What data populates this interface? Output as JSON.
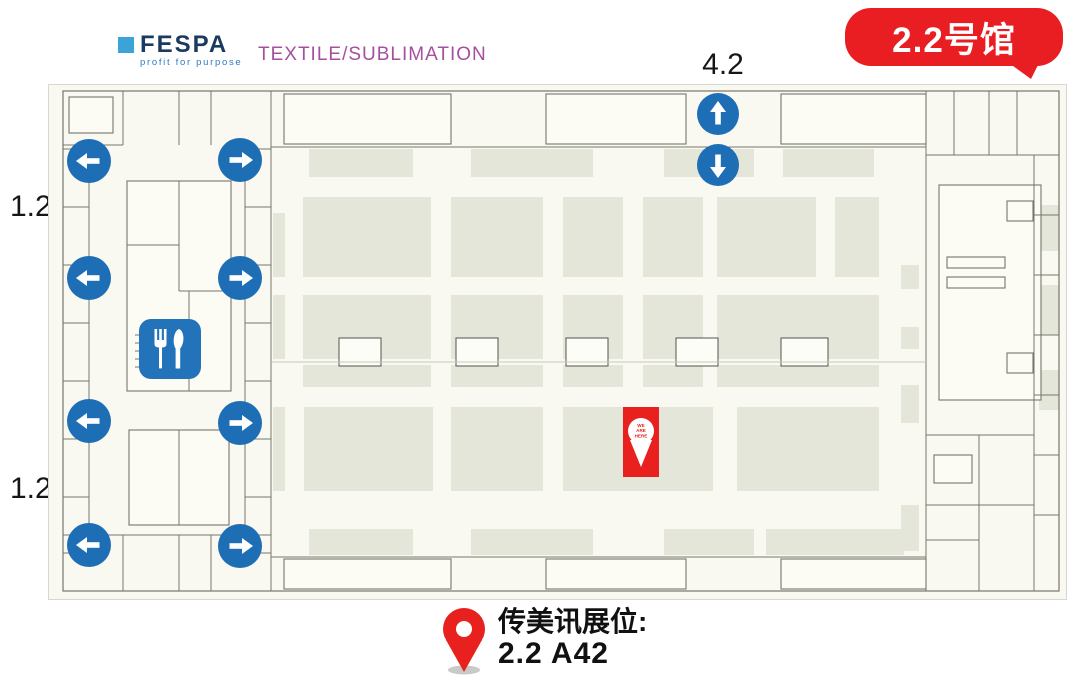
{
  "header": {
    "logo": {
      "name": "FESPA",
      "tagline": "profit for purpose"
    },
    "event_label": "TEXTILE/SUBLIMATION",
    "hall_badge": "2.2号馆"
  },
  "labels": {
    "top_hall": "4.2",
    "left_upper": "1.2",
    "left_lower": "1.2"
  },
  "legend": {
    "title": "传美讯展位:",
    "booth": "2.2 A42"
  },
  "colors": {
    "badge_red": "#e91e22",
    "marker_red": "#e8211f",
    "arrow_blue": "#1d6eb5",
    "restaurant_blue": "#2273b9",
    "fespa_navy": "#1a3a5f",
    "fespa_square_blue": "#3aa3d8",
    "fespa_tagline_blue": "#2e7cc0",
    "textile_purple": "#a4509e",
    "booth_sage": "#e4e6d9",
    "plan_background": "#faf9f1",
    "wall_gray": "#77766c"
  },
  "floorplan": {
    "width": 1017,
    "height": 514,
    "booth_color": "#e4e6d9",
    "room_fill": "#fcfbf4",
    "wall_color": "#77766c",
    "light_wall": "#c8c7ba",
    "boundary": [
      14,
      6,
      996,
      500
    ],
    "booths": [
      [
        260,
        64,
        104,
        28
      ],
      [
        422,
        64,
        122,
        28
      ],
      [
        615,
        64,
        90,
        28
      ],
      [
        734,
        64,
        91,
        28
      ],
      [
        254,
        112,
        128,
        80
      ],
      [
        402,
        112,
        92,
        80
      ],
      [
        514,
        112,
        60,
        80
      ],
      [
        594,
        112,
        60,
        80
      ],
      [
        668,
        112,
        99,
        80
      ],
      [
        786,
        112,
        44,
        80
      ],
      [
        254,
        210,
        128,
        64
      ],
      [
        402,
        210,
        92,
        64
      ],
      [
        514,
        210,
        60,
        64
      ],
      [
        594,
        210,
        60,
        64
      ],
      [
        668,
        210,
        162,
        64
      ],
      [
        254,
        280,
        128,
        22
      ],
      [
        402,
        280,
        92,
        22
      ],
      [
        514,
        280,
        60,
        22
      ],
      [
        594,
        280,
        60,
        22
      ],
      [
        668,
        280,
        162,
        22
      ],
      [
        255,
        322,
        129,
        84
      ],
      [
        402,
        322,
        92,
        84
      ],
      [
        514,
        322,
        150,
        84
      ],
      [
        688,
        322,
        142,
        84
      ],
      [
        260,
        444,
        104,
        26
      ],
      [
        422,
        444,
        122,
        26
      ],
      [
        615,
        444,
        90,
        26
      ],
      [
        717,
        444,
        138,
        26
      ],
      [
        224,
        128,
        12,
        64
      ],
      [
        224,
        210,
        12,
        64
      ],
      [
        224,
        322,
        12,
        84
      ],
      [
        852,
        180,
        18,
        24
      ],
      [
        852,
        242,
        18,
        22
      ],
      [
        852,
        300,
        18,
        38
      ],
      [
        852,
        420,
        18,
        46
      ],
      [
        990,
        120,
        20,
        46
      ],
      [
        990,
        200,
        20,
        50
      ],
      [
        990,
        285,
        20,
        40
      ]
    ],
    "rooms_outlined": [
      [
        235,
        9,
        167,
        50
      ],
      [
        497,
        9,
        140,
        50
      ],
      [
        732,
        9,
        145,
        50
      ],
      [
        235,
        474,
        167,
        30
      ],
      [
        497,
        474,
        140,
        30
      ],
      [
        732,
        474,
        145,
        30
      ],
      [
        78,
        96,
        104,
        210
      ],
      [
        80,
        345,
        100,
        95
      ],
      [
        20,
        12,
        44,
        36
      ],
      [
        890,
        100,
        102,
        215
      ],
      [
        898,
        172,
        58,
        11
      ],
      [
        898,
        192,
        58,
        11
      ],
      [
        958,
        116,
        26,
        20
      ],
      [
        958,
        268,
        26,
        20
      ],
      [
        885,
        370,
        38,
        28
      ]
    ],
    "inset_rooms": [
      [
        290,
        253,
        42,
        28
      ],
      [
        407,
        253,
        42,
        28
      ],
      [
        517,
        253,
        42,
        28
      ],
      [
        627,
        253,
        42,
        28
      ],
      [
        732,
        253,
        47,
        28
      ]
    ],
    "walls": [
      [
        222,
        6,
        222,
        506
      ],
      [
        877,
        6,
        877,
        506
      ],
      [
        40,
        64,
        40,
        468
      ],
      [
        14,
        64,
        40,
        64
      ],
      [
        14,
        122,
        40,
        122
      ],
      [
        14,
        180,
        40,
        180
      ],
      [
        14,
        238,
        40,
        238
      ],
      [
        14,
        296,
        40,
        296
      ],
      [
        14,
        354,
        40,
        354
      ],
      [
        14,
        412,
        40,
        412
      ],
      [
        14,
        468,
        40,
        468
      ],
      [
        196,
        64,
        196,
        468
      ],
      [
        196,
        64,
        222,
        64
      ],
      [
        196,
        122,
        222,
        122
      ],
      [
        196,
        180,
        222,
        180
      ],
      [
        196,
        238,
        222,
        238
      ],
      [
        196,
        296,
        222,
        296
      ],
      [
        196,
        354,
        222,
        354
      ],
      [
        196,
        412,
        222,
        412
      ],
      [
        196,
        468,
        222,
        468
      ],
      [
        74,
        6,
        74,
        60
      ],
      [
        130,
        6,
        130,
        60
      ],
      [
        162,
        6,
        162,
        60
      ],
      [
        14,
        60,
        74,
        60
      ],
      [
        14,
        450,
        222,
        450
      ],
      [
        74,
        450,
        74,
        506
      ],
      [
        130,
        450,
        130,
        506
      ],
      [
        162,
        450,
        162,
        506
      ],
      [
        130,
        96,
        130,
        206
      ],
      [
        78,
        160,
        130,
        160
      ],
      [
        130,
        206,
        182,
        206
      ],
      [
        140,
        206,
        140,
        306
      ],
      [
        86,
        250,
        116,
        250
      ],
      [
        86,
        258,
        116,
        258
      ],
      [
        86,
        266,
        116,
        266
      ],
      [
        86,
        274,
        116,
        274
      ],
      [
        86,
        282,
        116,
        282
      ],
      [
        116,
        246,
        116,
        286
      ],
      [
        130,
        345,
        130,
        440
      ],
      [
        877,
        70,
        1010,
        70
      ],
      [
        905,
        6,
        905,
        70
      ],
      [
        940,
        6,
        940,
        70
      ],
      [
        968,
        6,
        968,
        70
      ],
      [
        985,
        70,
        985,
        506
      ],
      [
        985,
        130,
        1010,
        130
      ],
      [
        985,
        190,
        1010,
        190
      ],
      [
        985,
        250,
        1010,
        250
      ],
      [
        985,
        310,
        1010,
        310
      ],
      [
        985,
        370,
        1010,
        370
      ],
      [
        985,
        430,
        1010,
        430
      ],
      [
        877,
        350,
        985,
        350
      ],
      [
        877,
        420,
        985,
        420
      ],
      [
        930,
        350,
        930,
        506
      ],
      [
        877,
        455,
        930,
        455
      ],
      [
        222,
        472,
        877,
        472
      ],
      [
        222,
        62,
        877,
        62
      ]
    ],
    "light_lines": [
      [
        222,
        277,
        877,
        277
      ]
    ],
    "arrows": {
      "color": "#1d6eb5",
      "left": [
        [
          40,
          76
        ],
        [
          40,
          193
        ],
        [
          40,
          336
        ],
        [
          40,
          460
        ]
      ],
      "right": [
        [
          191,
          75
        ],
        [
          191,
          193
        ],
        [
          191,
          338
        ],
        [
          191,
          461
        ]
      ],
      "up": [
        669,
        29
      ],
      "down": [
        669,
        80
      ]
    },
    "restaurant": {
      "x": 90,
      "y": 234,
      "w": 62,
      "h": 60,
      "color": "#2273b9"
    },
    "marker": {
      "x": 574,
      "y": 322,
      "w": 36,
      "h": 70,
      "color": "#e8211f",
      "lines": [
        "WE",
        "ARE",
        "HERE"
      ]
    }
  }
}
